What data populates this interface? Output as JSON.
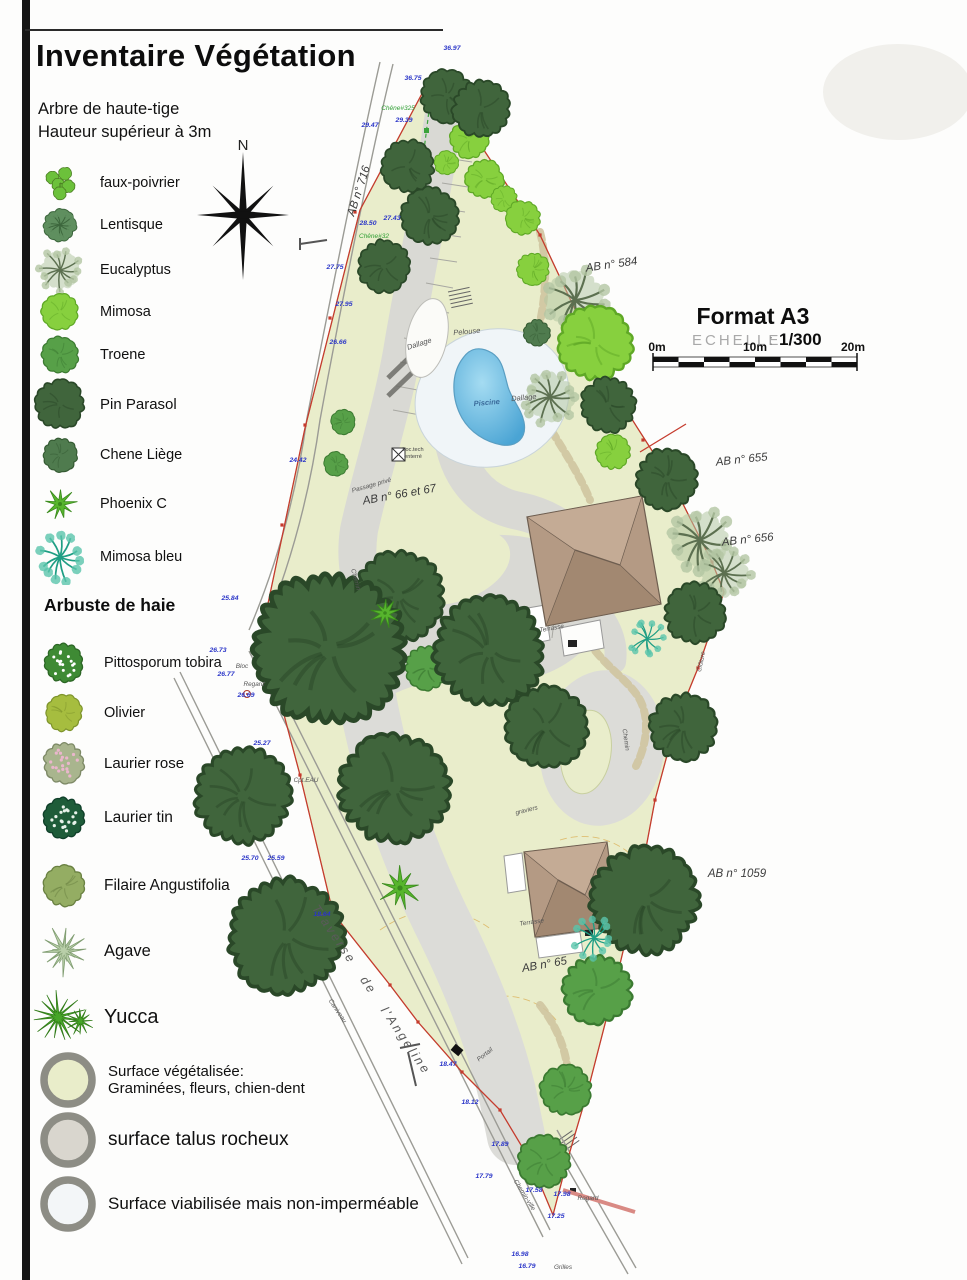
{
  "title": "Inventaire Végétation",
  "legend": {
    "section1_line1": "Arbre de haute-tige",
    "section1_line2": "Hauteur supérieur à 3m",
    "trees": [
      {
        "label": "faux-poivrier",
        "kind": "clump",
        "color": "#6cc13b",
        "line": "#4c7f24"
      },
      {
        "label": "Lentisque",
        "kind": "textured",
        "color": "#5f8f5f",
        "line": "#3c663c"
      },
      {
        "label": "Eucalyptus",
        "kind": "spray-pale",
        "color": "#b3c6a3",
        "line": "#5c7050"
      },
      {
        "label": "Mimosa",
        "kind": "blob",
        "color": "#87d03e",
        "line": "#5fa826"
      },
      {
        "label": "Troene",
        "kind": "blob",
        "color": "#57a048",
        "line": "#3b7a31"
      },
      {
        "label": "Pin Parasol",
        "kind": "blob",
        "color": "#40653c",
        "line": "#2a4828"
      },
      {
        "label": "Chene Liège",
        "kind": "blob",
        "color": "#4f7b4e",
        "line": "#345a32"
      },
      {
        "label": "Phoenix C",
        "kind": "star",
        "color": "#57b52d",
        "line": "#3a8a1d"
      },
      {
        "label": "Mimosa bleu",
        "kind": "spray",
        "color": "#5ac4ab",
        "line": "#1f9e84"
      }
    ],
    "section2": "Arbuste de haie",
    "shrubs": [
      {
        "label": "Pittosporum tobira",
        "kind": "dotted",
        "color": "#3e8a34",
        "dot": "#ffffff",
        "line": "#2c6625"
      },
      {
        "label": "Olivier",
        "kind": "blob",
        "color": "#a6bd3f",
        "line": "#7e942c"
      },
      {
        "label": "Laurier rose",
        "kind": "dotted",
        "color": "#a9b58e",
        "dot": "#eab6cc",
        "line": "#7e8a67"
      },
      {
        "label": "Laurier tin",
        "kind": "dotted",
        "color": "#1e5c39",
        "dot": "#e8f2ea",
        "line": "#10402a"
      },
      {
        "label": "Filaire Angustifolia",
        "kind": "blob",
        "color": "#94ad63",
        "line": "#6a8142"
      },
      {
        "label": "Agave",
        "kind": "agave",
        "color": "#b9cfa9",
        "line": "#7f9c70"
      },
      {
        "label": "Yucca",
        "kind": "yucca",
        "color": "#47a528",
        "line": "#2f7a16"
      }
    ],
    "surfaces": [
      {
        "label": "Surface végétalisée:",
        "label2": "Graminées, fleurs, chien-dent",
        "fill": "#e9edca"
      },
      {
        "label": "surface talus rocheux",
        "label2": "",
        "fill": "#d9d6ce"
      },
      {
        "label": "Surface viabilisée mais non-imperméable",
        "label2": "",
        "fill": "#f3f6f8"
      }
    ]
  },
  "compass": {
    "label": "N"
  },
  "titleblock": {
    "format": "Format A3",
    "echelle_label": "ECHELLE",
    "echelle_sep": ":",
    "echelle_value": "1/300",
    "scale_ticks": [
      "0m",
      "10m",
      "20m"
    ]
  },
  "plan": {
    "colors": {
      "land": "#e9edcb",
      "land_edge": "#b9c08f",
      "road": "#d9d9d4",
      "deck": "#f0f5f8",
      "pool_light": "#a5dcf2",
      "pool_dark": "#4aa4d4",
      "roof": "#b49a84",
      "roof_light": "#c4ab95",
      "roof_dark": "#a28871",
      "roof_line": "#6e5e50",
      "boundary": "#c53b2d",
      "elevation_text": "#2a35c8"
    },
    "parcels": [
      {
        "t": "AB n° 716",
        "x": 362,
        "y": 192,
        "rot": -72
      },
      {
        "t": "AB n° 584",
        "x": 612,
        "y": 268,
        "rot": -8
      },
      {
        "t": "AB n° 655",
        "x": 742,
        "y": 463,
        "rot": -6
      },
      {
        "t": "AB n° 656",
        "x": 748,
        "y": 543,
        "rot": -6
      },
      {
        "t": "AB n° 1059",
        "x": 737,
        "y": 877,
        "rot": 0
      },
      {
        "t": "AB n° 65",
        "x": 545,
        "y": 968,
        "rot": -10
      },
      {
        "t": "AB n° 66 et 67",
        "x": 400,
        "y": 498,
        "rot": -10
      }
    ],
    "labels": [
      {
        "t": "Pelouse",
        "x": 467,
        "y": 334,
        "rot": -5,
        "c": "std"
      },
      {
        "t": "Dallage",
        "x": 420,
        "y": 346,
        "rot": -18,
        "c": "std"
      },
      {
        "t": "Dallage",
        "x": 524,
        "y": 400,
        "rot": -5,
        "c": "std"
      },
      {
        "t": "Piscine",
        "x": 487,
        "y": 405,
        "rot": -5,
        "c": "blue"
      },
      {
        "t": "Terrasse",
        "x": 552,
        "y": 630,
        "rot": -10,
        "c": "sm"
      },
      {
        "t": "Terrasse",
        "x": 532,
        "y": 924,
        "rot": -8,
        "c": "sm"
      },
      {
        "t": "graviers",
        "x": 527,
        "y": 812,
        "rot": -14,
        "c": "sm"
      },
      {
        "t": "Passage privé",
        "x": 372,
        "y": 487,
        "rot": -16,
        "c": "sm"
      },
      {
        "t": "Loc.tech",
        "x": 413,
        "y": 451,
        "rot": 0,
        "c": "tiny"
      },
      {
        "t": "enterré",
        "x": 413,
        "y": 458,
        "rot": 0,
        "c": "tiny"
      },
      {
        "t": "Chemin",
        "x": 354,
        "y": 580,
        "rot": 75,
        "c": "sm"
      },
      {
        "t": "Chemin",
        "x": 624,
        "y": 740,
        "rot": 82,
        "c": "sm"
      },
      {
        "t": "Portail",
        "x": 486,
        "y": 1056,
        "rot": -38,
        "c": "sm"
      },
      {
        "t": "Bloc",
        "x": 242,
        "y": 668,
        "rot": 0,
        "c": "sm"
      },
      {
        "t": "Regard",
        "x": 254,
        "y": 686,
        "rot": 0,
        "c": "sm"
      },
      {
        "t": "Cpt.EAU",
        "x": 306,
        "y": 782,
        "rot": 0,
        "c": "sm"
      },
      {
        "t": "Clôture",
        "x": 703,
        "y": 662,
        "rot": -78,
        "c": "sm"
      },
      {
        "t": "Traverse de l'Angeline",
        "x": 368,
        "y": 992,
        "rot": 56,
        "c": "street"
      },
      {
        "t": "Caniveau",
        "x": 336,
        "y": 1012,
        "rot": 56,
        "c": "sm"
      },
      {
        "t": "Chemin-ville",
        "x": 523,
        "y": 1196,
        "rot": 58,
        "c": "sm"
      },
      {
        "t": "Regard",
        "x": 588,
        "y": 1200,
        "rot": 0,
        "c": "sm"
      },
      {
        "t": "Grilles",
        "x": 563,
        "y": 1269,
        "rot": 0,
        "c": "sm"
      },
      {
        "t": "Chêne#325",
        "x": 398,
        "y": 110,
        "rot": 0,
        "c": "green"
      },
      {
        "t": "Chêne#32",
        "x": 374,
        "y": 238,
        "rot": 0,
        "c": "green"
      }
    ],
    "elevations": [
      {
        "v": "36.97",
        "x": 452,
        "y": 50
      },
      {
        "v": "36.75",
        "x": 413,
        "y": 80
      },
      {
        "v": "29.39",
        "x": 404,
        "y": 122
      },
      {
        "v": "29.47",
        "x": 370,
        "y": 127
      },
      {
        "v": "28.50",
        "x": 368,
        "y": 225
      },
      {
        "v": "27.43",
        "x": 392,
        "y": 220
      },
      {
        "v": "27.75",
        "x": 335,
        "y": 269
      },
      {
        "v": "27.95",
        "x": 344,
        "y": 306
      },
      {
        "v": "26.66",
        "x": 338,
        "y": 344
      },
      {
        "v": "24.42",
        "x": 298,
        "y": 462
      },
      {
        "v": "25.84",
        "x": 230,
        "y": 600
      },
      {
        "v": "26.73",
        "x": 218,
        "y": 652
      },
      {
        "v": "26.77",
        "x": 226,
        "y": 676
      },
      {
        "v": "26.69",
        "x": 246,
        "y": 697
      },
      {
        "v": "25.27",
        "x": 262,
        "y": 745
      },
      {
        "v": "25.70",
        "x": 250,
        "y": 860
      },
      {
        "v": "25.59",
        "x": 276,
        "y": 860
      },
      {
        "v": "18.64",
        "x": 322,
        "y": 916
      },
      {
        "v": "18.47",
        "x": 448,
        "y": 1066
      },
      {
        "v": "18.12",
        "x": 470,
        "y": 1104
      },
      {
        "v": "17.89",
        "x": 500,
        "y": 1146
      },
      {
        "v": "17.79",
        "x": 484,
        "y": 1178
      },
      {
        "v": "17.58",
        "x": 534,
        "y": 1192
      },
      {
        "v": "17.98",
        "x": 562,
        "y": 1196
      },
      {
        "v": "17.25",
        "x": 556,
        "y": 1218
      },
      {
        "v": "16.98",
        "x": 520,
        "y": 1256
      },
      {
        "v": "16.79",
        "x": 527,
        "y": 1268
      }
    ],
    "trees": [
      {
        "type": "eucalyptus",
        "x": 575,
        "y": 300,
        "r": 30
      },
      {
        "type": "eucalyptus",
        "x": 550,
        "y": 397,
        "r": 25
      },
      {
        "type": "eucalyptus",
        "x": 700,
        "y": 540,
        "r": 30
      },
      {
        "type": "eucalyptus",
        "x": 724,
        "y": 573,
        "r": 25
      },
      {
        "type": "mimosa",
        "x": 469,
        "y": 139,
        "r": 19
      },
      {
        "type": "mimosa",
        "x": 446,
        "y": 163,
        "r": 12
      },
      {
        "type": "mimosa",
        "x": 484,
        "y": 179,
        "r": 19
      },
      {
        "type": "mimosa",
        "x": 504,
        "y": 199,
        "r": 13
      },
      {
        "type": "mimosa",
        "x": 523,
        "y": 218,
        "r": 17
      },
      {
        "type": "mimosa",
        "x": 533,
        "y": 269,
        "r": 16
      },
      {
        "type": "mimosa",
        "x": 595,
        "y": 343,
        "r": 36
      },
      {
        "type": "mimosa",
        "x": 613,
        "y": 452,
        "r": 17
      },
      {
        "type": "chene-liege",
        "x": 537,
        "y": 333,
        "r": 13
      },
      {
        "type": "troene",
        "x": 343,
        "y": 422,
        "r": 12
      },
      {
        "type": "troene",
        "x": 336,
        "y": 464,
        "r": 12
      },
      {
        "type": "troene",
        "x": 427,
        "y": 668,
        "r": 22
      },
      {
        "type": "troene",
        "x": 597,
        "y": 990,
        "r": 34
      },
      {
        "type": "troene",
        "x": 566,
        "y": 1090,
        "r": 25
      },
      {
        "type": "troene",
        "x": 544,
        "y": 1161,
        "r": 26
      },
      {
        "type": "pin-parasol",
        "x": 447,
        "y": 96,
        "r": 26
      },
      {
        "type": "pin-parasol",
        "x": 481,
        "y": 109,
        "r": 28
      },
      {
        "type": "pin-parasol",
        "x": 408,
        "y": 166,
        "r": 26
      },
      {
        "type": "pin-parasol",
        "x": 430,
        "y": 216,
        "r": 28
      },
      {
        "type": "pin-parasol",
        "x": 384,
        "y": 266,
        "r": 26
      },
      {
        "type": "pin-parasol",
        "x": 608,
        "y": 405,
        "r": 27
      },
      {
        "type": "pin-parasol",
        "x": 667,
        "y": 479,
        "r": 30
      },
      {
        "type": "pin-parasol",
        "x": 695,
        "y": 613,
        "r": 30
      },
      {
        "type": "pin-parasol",
        "x": 683,
        "y": 727,
        "r": 33
      },
      {
        "type": "pin-parasol",
        "x": 398,
        "y": 596,
        "r": 44
      },
      {
        "type": "pin-parasol",
        "x": 329,
        "y": 649,
        "r": 74
      },
      {
        "type": "pin-parasol",
        "x": 489,
        "y": 651,
        "r": 54
      },
      {
        "type": "pin-parasol",
        "x": 546,
        "y": 727,
        "r": 40
      },
      {
        "type": "pin-parasol",
        "x": 394,
        "y": 788,
        "r": 54
      },
      {
        "type": "pin-parasol",
        "x": 243,
        "y": 796,
        "r": 47
      },
      {
        "type": "pin-parasol",
        "x": 286,
        "y": 937,
        "r": 56
      },
      {
        "type": "pin-parasol",
        "x": 645,
        "y": 900,
        "r": 52
      },
      {
        "type": "mimosa-bleu",
        "x": 647,
        "y": 639,
        "r": 17
      },
      {
        "type": "mimosa-bleu",
        "x": 594,
        "y": 938,
        "r": 19
      },
      {
        "type": "phoenix",
        "x": 385,
        "y": 613,
        "r": 15
      },
      {
        "type": "phoenix",
        "x": 400,
        "y": 888,
        "r": 22
      }
    ]
  }
}
